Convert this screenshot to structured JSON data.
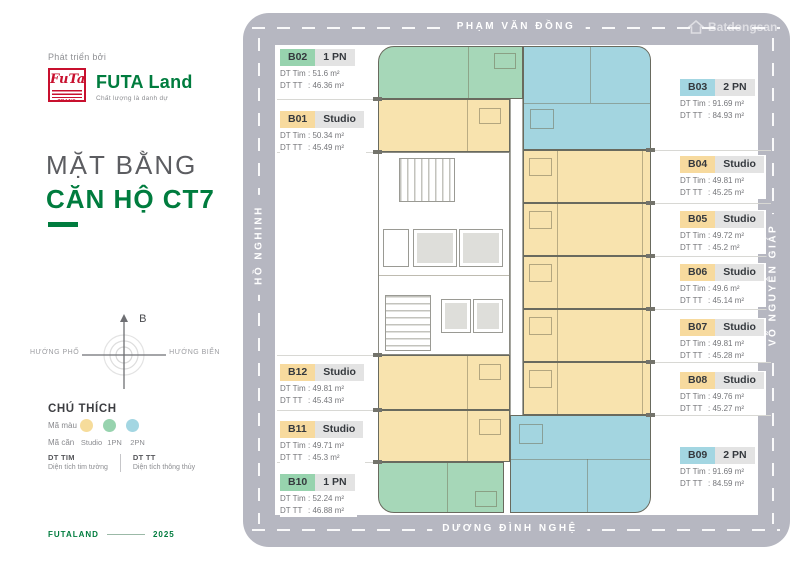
{
  "sidebar": {
    "developed_by": "Phát triển bởi",
    "logo": {
      "emblem_text": "FuTa",
      "emblem_sub": "PHƯƠNG TRANG",
      "brand": "FUTA Land",
      "tagline": "Chất lượng là danh dự",
      "brand_color": "#007c3e",
      "emblem_color": "#c8102e"
    },
    "title": {
      "line1": "MẶT BẰNG",
      "line2": "CĂN HỘ CT7"
    },
    "compass": {
      "north_label": "B",
      "west_label": "HƯỚNG PHỐ",
      "east_label": "HƯỚNG BIỂN"
    },
    "legend": {
      "heading": "CHÚ THÍCH",
      "color_row_label": "Mã màu",
      "type_row_label": "Mã căn",
      "types": [
        {
          "label": "Studio",
          "color": "#f6dc9b"
        },
        {
          "label": "1PN",
          "color": "#97d3ae"
        },
        {
          "label": "2PN",
          "color": "#a3d6e2"
        }
      ],
      "dt_tim_abbr": "DT TIM",
      "dt_tim_desc": "Diện tích tim tường",
      "dt_tt_abbr": "DT TT",
      "dt_tt_desc": "Diện tích thông thủy"
    },
    "footer": {
      "brand": "FUTALAND",
      "year": "2025"
    }
  },
  "plan": {
    "streets": {
      "top": "PHẠM VĂN ĐỒNG",
      "bottom": "DƯƠNG ĐÌNH NGHỆ",
      "left": "HỒ NGHINH",
      "right": "VÕ NGUYÊN GIÁP"
    },
    "watermark": "Batdongsan",
    "colors": {
      "road": "#b6b7c1",
      "studio_fill": "#f8e3ae",
      "one_bedroom_fill": "#a6d7b8",
      "two_bedroom_fill": "#a3d5e0"
    }
  },
  "labels": {
    "dt_tim": "DT Tim",
    "dt_tt": "DT TT"
  },
  "units": [
    {
      "id": "B02",
      "type": "1 PN",
      "dt_tim": ": 51.6  m²",
      "dt_tt": ": 46.36 m²"
    },
    {
      "id": "B01",
      "type": "Studio",
      "dt_tim": ": 50.34 m²",
      "dt_tt": ": 45.49 m²"
    },
    {
      "id": "B12",
      "type": "Studio",
      "dt_tim": ": 49.81 m²",
      "dt_tt": ": 45.43 m²"
    },
    {
      "id": "B11",
      "type": "Studio",
      "dt_tim": ": 49.71 m²",
      "dt_tt": ": 45.3  m²"
    },
    {
      "id": "B10",
      "type": "1 PN",
      "dt_tim": ": 52.24 m²",
      "dt_tt": ": 46.88 m²"
    },
    {
      "id": "B03",
      "type": "2 PN",
      "dt_tim": ": 91.69 m²",
      "dt_tt": ": 84.93 m²"
    },
    {
      "id": "B04",
      "type": "Studio",
      "dt_tim": ": 49.81 m²",
      "dt_tt": ": 45.25 m²"
    },
    {
      "id": "B05",
      "type": "Studio",
      "dt_tim": ": 49.72 m²",
      "dt_tt": ": 45.2  m²"
    },
    {
      "id": "B06",
      "type": "Studio",
      "dt_tim": ": 49.6  m²",
      "dt_tt": ": 45.14 m²"
    },
    {
      "id": "B07",
      "type": "Studio",
      "dt_tim": ": 49.81 m²",
      "dt_tt": ": 45.28 m²"
    },
    {
      "id": "B08",
      "type": "Studio",
      "dt_tim": ": 49.76 m²",
      "dt_tt": ": 45.27 m²"
    },
    {
      "id": "B09",
      "type": "2 PN",
      "dt_tim": ": 91.69 m²",
      "dt_tt": ": 84.59 m²"
    }
  ]
}
